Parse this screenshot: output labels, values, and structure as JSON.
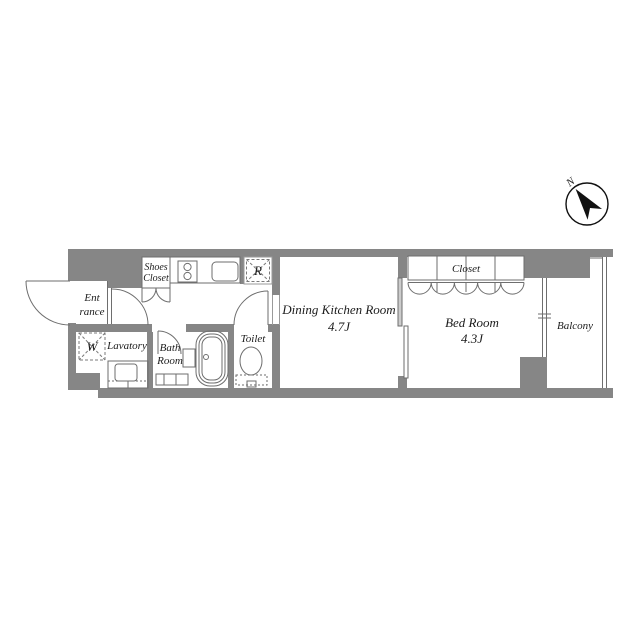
{
  "floor_plan": {
    "compass": {
      "north_label": "N"
    },
    "rooms": {
      "entrance": {
        "label_line1": "Ent",
        "label_line2": "rance"
      },
      "shoes_closet": {
        "label_line1": "Shoes",
        "label_line2": "Closet"
      },
      "washer": {
        "label": "W"
      },
      "lavatory": {
        "label": "Lavatory"
      },
      "bath": {
        "label_line1": "Bath",
        "label_line2": "Room"
      },
      "toilet": {
        "label": "Toilet"
      },
      "refrigerator": {
        "label": "R"
      },
      "dining_kitchen": {
        "label": "Dining Kitchen Room",
        "size": "4.7J"
      },
      "bed_room": {
        "label": "Bed Room",
        "size": "4.3J"
      },
      "closet": {
        "label": "Closet"
      },
      "balcony": {
        "label": "Balcony"
      }
    },
    "colors": {
      "wall": "#868686",
      "fixture_line": "#6e6e6e",
      "background": "#ffffff"
    }
  }
}
